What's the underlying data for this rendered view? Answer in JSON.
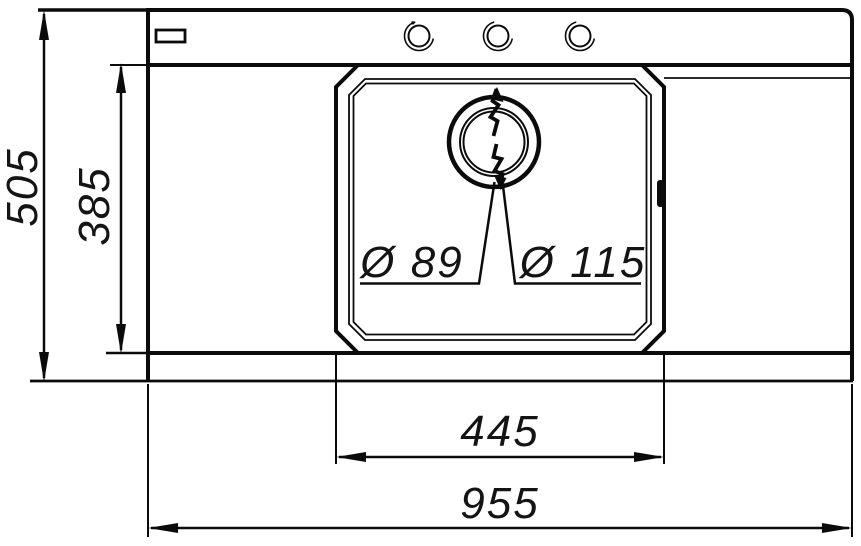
{
  "meta": {
    "type": "technical-drawing",
    "subject": "Kitchen sink top view with dimensions",
    "background_color": "#ffffff",
    "line_color": "#0b0b0b"
  },
  "dimensions": {
    "overall_height": "505",
    "inner_depth": "385",
    "drain_inner_diameter": "Ø 89",
    "drain_outer_diameter": "Ø 115",
    "bowl_width": "445",
    "overall_width": "955"
  }
}
